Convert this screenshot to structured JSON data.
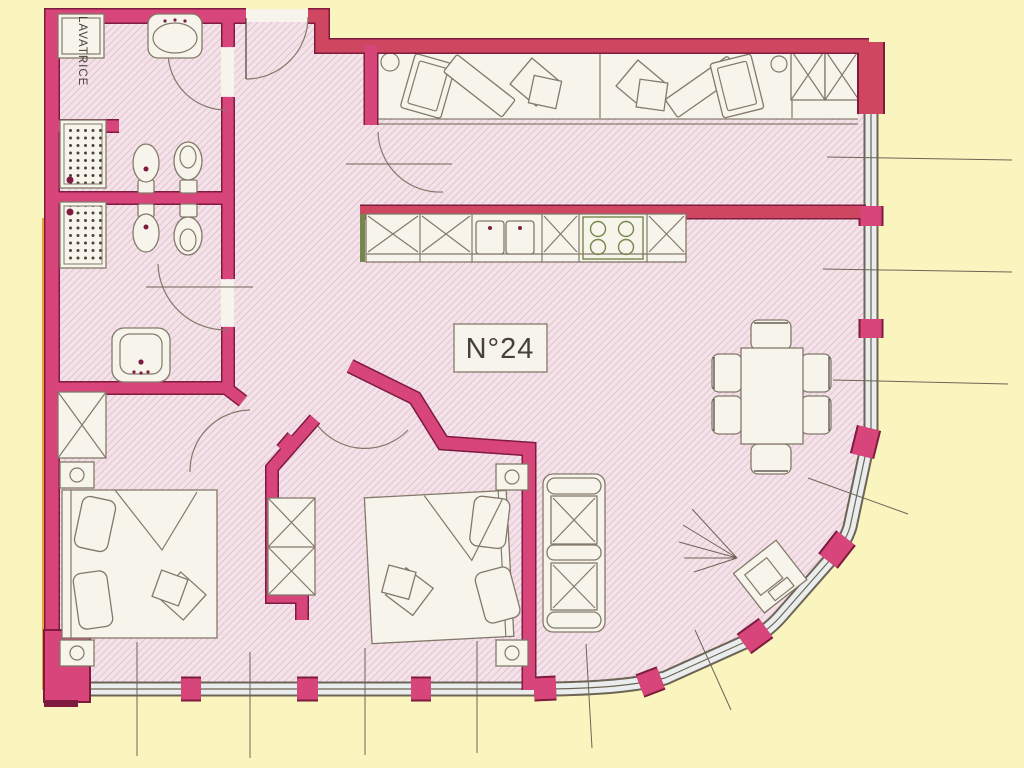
{
  "plan": {
    "apartment_label": "N°24",
    "laundry_label": "LAVATRICE"
  },
  "colors": {
    "background": "#FAF5BE",
    "wall_magenta": "#D8457A",
    "wall_red": "#CE4660",
    "wall_outline": "#7E1B3E",
    "floor": "#F3E2E8",
    "hatch": "#E6C4D2",
    "paper": "#F7F4EC",
    "line": "#83796A",
    "line_dark": "#6E6456",
    "window_glass": "#E9EDED",
    "green": "#75874B",
    "gold": "#E8A33D",
    "ink": "#45403A"
  }
}
